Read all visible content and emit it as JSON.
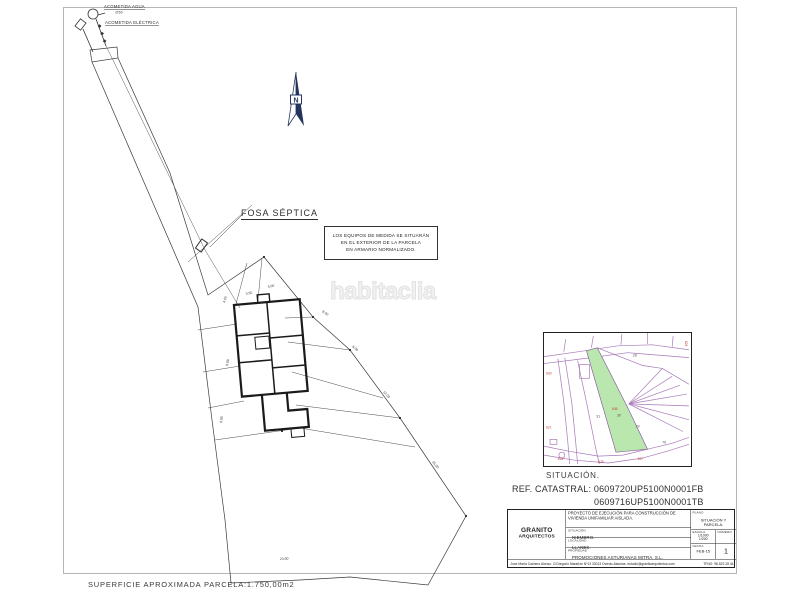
{
  "plan": {
    "watermark": "habitaclia",
    "acometida_agua": "ACOMETIDA AGUA",
    "acometida_agua_sub": "∅50",
    "acometida_electrica": "ACOMETIDA ELÉCTRICA",
    "fosa_septica": "FOSA SÉPTICA",
    "north": "N",
    "note_lines": [
      "LOS EQUIPOS DE MEDIDA SE SITUARÁN",
      "EN EL EXTERIOR DE LA PARCELA",
      "EN ARMARIO NORMALIZADO."
    ],
    "superficie": "SUPERFICIE APROXIMADA PARCELA:1.750,00m2",
    "dims": [
      "4.00",
      "3.50",
      "5.00",
      "8.00",
      "6.00",
      "12.00",
      "15.00",
      "9.00",
      "8.50",
      "24.00"
    ]
  },
  "inset": {
    "situacion": "SITUACIÓN.",
    "ref_label": "REF. CATASTRAL:",
    "ref_1": "0609720UP5100N0001FB",
    "ref_2": "0609716UP5100N0001TB",
    "parcels": [
      "28",
      "31",
      "30",
      "29",
      "76"
    ],
    "red_labels": [
      "630",
      "621",
      "636",
      "628",
      "625",
      "627",
      "626"
    ]
  },
  "titleblock": {
    "firm_line1": "GRANITO",
    "firm_line2": "ARQUITECTOS",
    "project": "PROYECTO DE EJECUCIÓN PARA CONSTRUCCIÓN DE VIVIENDA UNIFAMILIAR AISLADA.",
    "situacion_label": "SITUACIÓN",
    "situacion": "NIEMBRO.",
    "localidad_label": "LOCALIDAD",
    "localidad": "LLANES.",
    "propiedad_label": "PROPIEDAD",
    "propiedad": "PROMOCIONES ASTURIANAS MITRA, S.L.",
    "plano_label": "PLANO",
    "plano": "SITUACIÓN Y PARCELA.",
    "escala_label": "ESCALA",
    "escala_1": "1/1000",
    "escala_2": "1/200",
    "numero_label": "NÚMERO",
    "numero": "1",
    "fecha_label": "FECHA",
    "fecha": "FEB-15",
    "footer_left": "Jose María Cachero Alonso. C/Gregorio Marañón Nº13 33013 Oviedo-Asturias. estudio@granitoarquitectos.com",
    "footer_right": "TFNO: 98-523 28 44"
  },
  "colors": {
    "line": "#3a3a3a",
    "building": "#1a1a1a",
    "north_blue": "#23355c",
    "inset_line": "#a678b8",
    "inset_green": "#b9e7ae",
    "inset_red": "#c23b3b",
    "watermark": "#f1f1f1"
  }
}
